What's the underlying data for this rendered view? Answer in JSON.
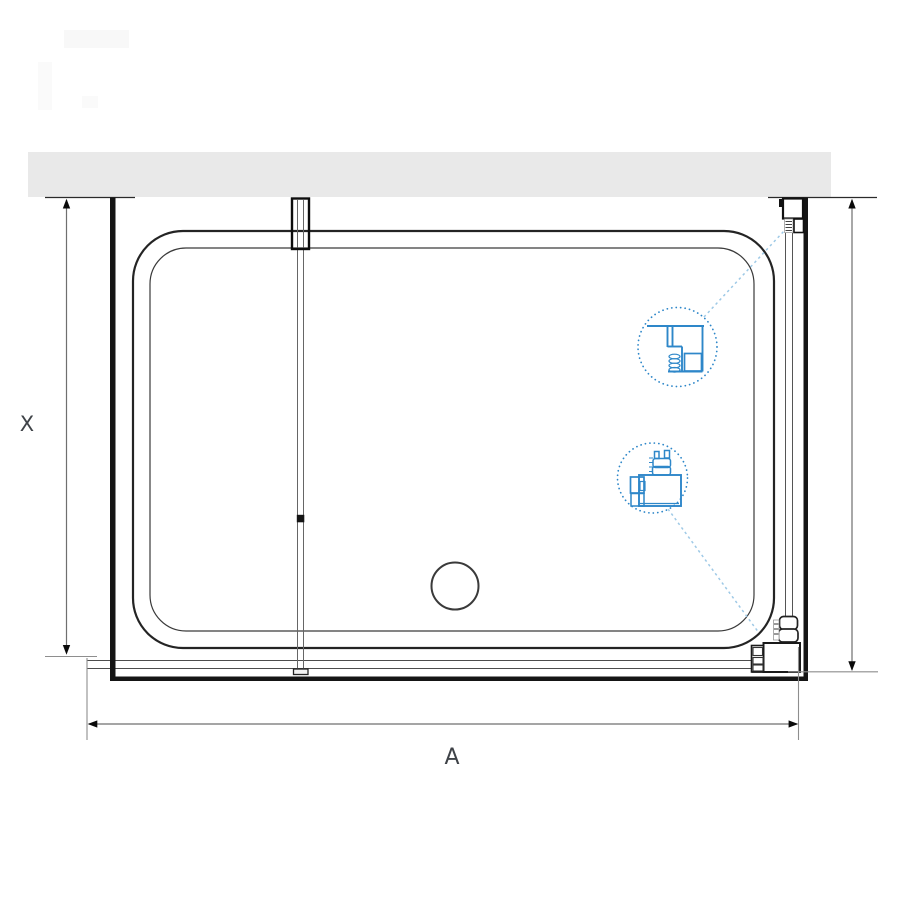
{
  "diagram": {
    "dimension_labels": {
      "horizontal": "A",
      "vertical": "X"
    },
    "callouts": {
      "top": "wall-profile-detail-icon",
      "bottom": "floor-bracket-detail-icon"
    }
  },
  "colors": {
    "background": "#ffffff",
    "wall_fill": "#e9e9e9",
    "outline_dark": "#1f1f1f",
    "thick_panel": "#151515",
    "dim_line": "#6f6f6f",
    "ext_line": "#8e8e8e",
    "accent_blue": "#2e87c9",
    "leader_blue": "#9ec9e6"
  }
}
